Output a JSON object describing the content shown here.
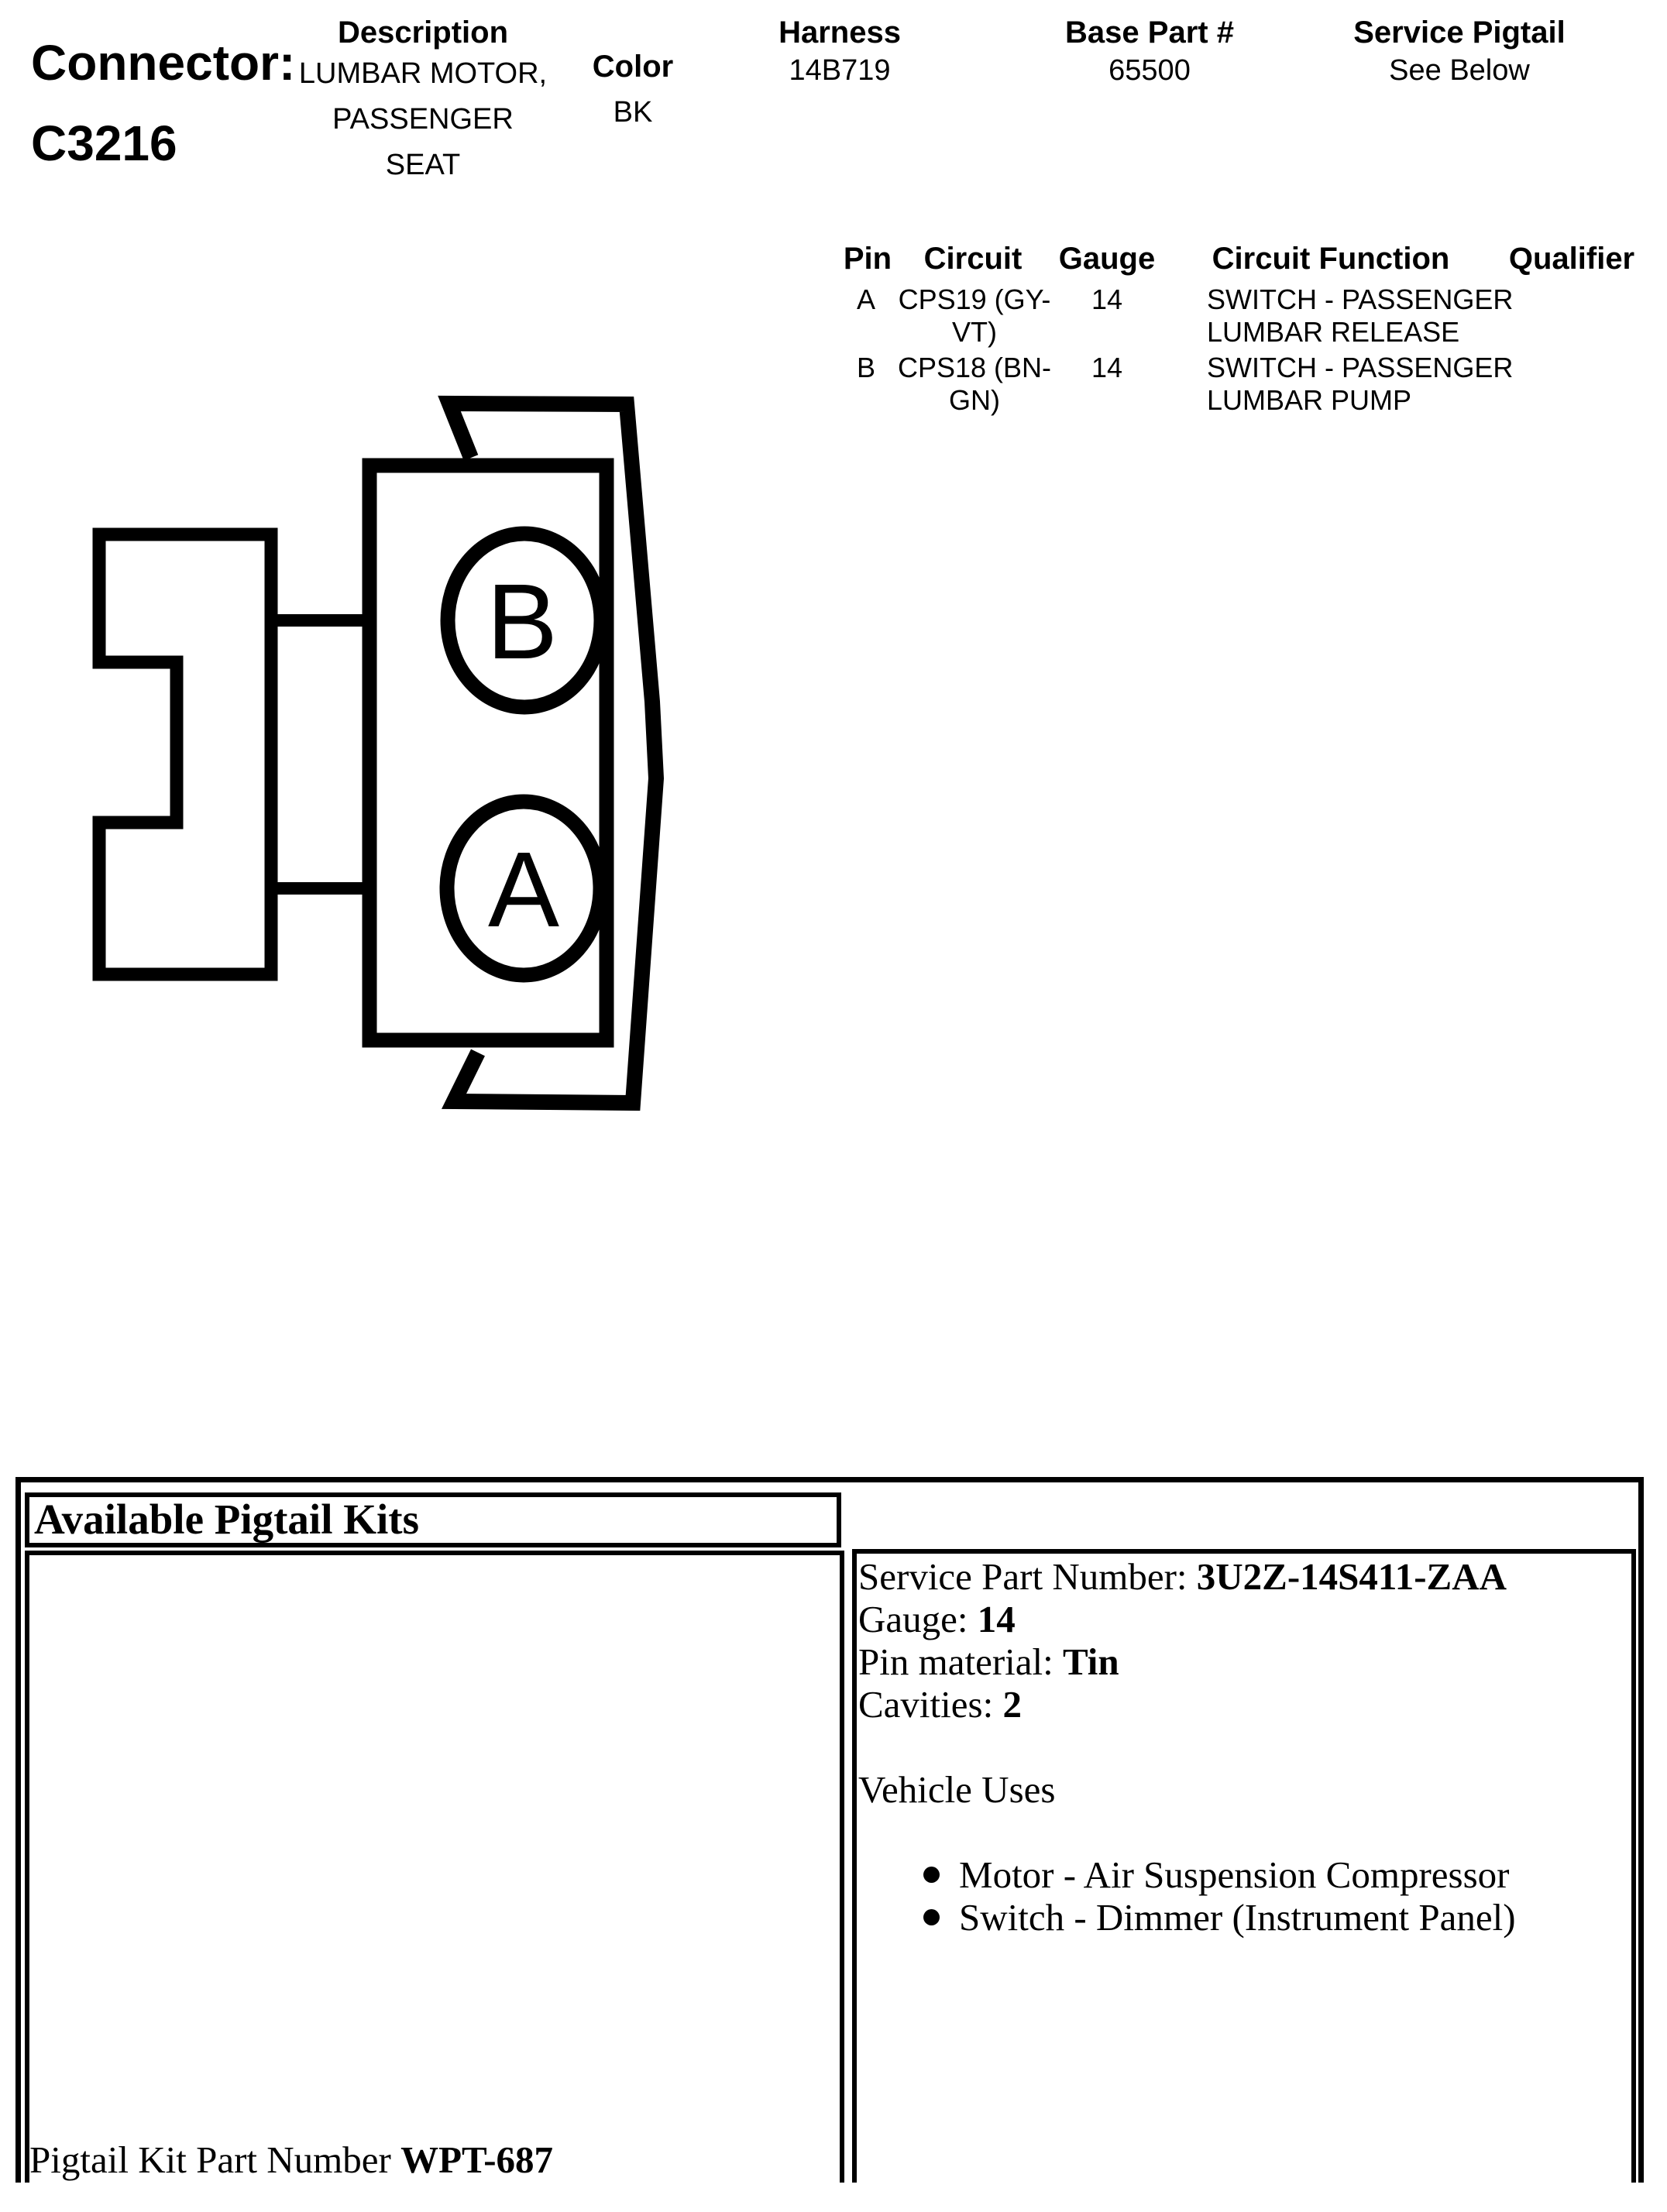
{
  "colors": {
    "ink": "#000000",
    "background": "#ffffff"
  },
  "header": {
    "connector_label": "Connector:",
    "connector_id": "C3216",
    "columns": {
      "description": {
        "label": "Description",
        "lines": [
          "LUMBAR MOTOR,",
          "PASSENGER",
          "SEAT"
        ]
      },
      "color": {
        "label": "Color",
        "value": "BK"
      },
      "harness": {
        "label": "Harness",
        "value": "14B719"
      },
      "base_part": {
        "label": "Base Part #",
        "value": "65500"
      },
      "service_pigtail": {
        "label": "Service Pigtail",
        "value": "See Below"
      }
    }
  },
  "pin_table": {
    "headers": {
      "pin": "Pin",
      "circuit": "Circuit",
      "gauge": "Gauge",
      "function": "Circuit Function",
      "qualifier": "Qualifier"
    },
    "rows": [
      {
        "pin": "A",
        "circuit": [
          "CPS19 (GY-",
          "VT)"
        ],
        "gauge": "14",
        "function": [
          "SWITCH - PASSENGER",
          "LUMBAR RELEASE"
        ],
        "qualifier": ""
      },
      {
        "pin": "B",
        "circuit": [
          "CPS18 (BN-",
          "GN)"
        ],
        "gauge": "14",
        "function": [
          "SWITCH - PASSENGER",
          "LUMBAR PUMP"
        ],
        "qualifier": ""
      }
    ]
  },
  "diagram": {
    "pin_b_label": "B",
    "pin_a_label": "A"
  },
  "pigtail": {
    "title": "Available Pigtail Kits",
    "kit_label": "Pigtail Kit Part Number",
    "kit_number": "WPT-687",
    "details": [
      {
        "label": "Service Part Number:",
        "value": "3U2Z-14S411-ZAA"
      },
      {
        "label": "Gauge:",
        "value": "14"
      },
      {
        "label": "Pin material:",
        "value": "Tin"
      },
      {
        "label": "Cavities:",
        "value": "2"
      }
    ],
    "vehicle_uses_label": "Vehicle Uses",
    "vehicle_uses": [
      "Motor - Air Suspension Compressor",
      "Switch - Dimmer (Instrument Panel)"
    ]
  }
}
